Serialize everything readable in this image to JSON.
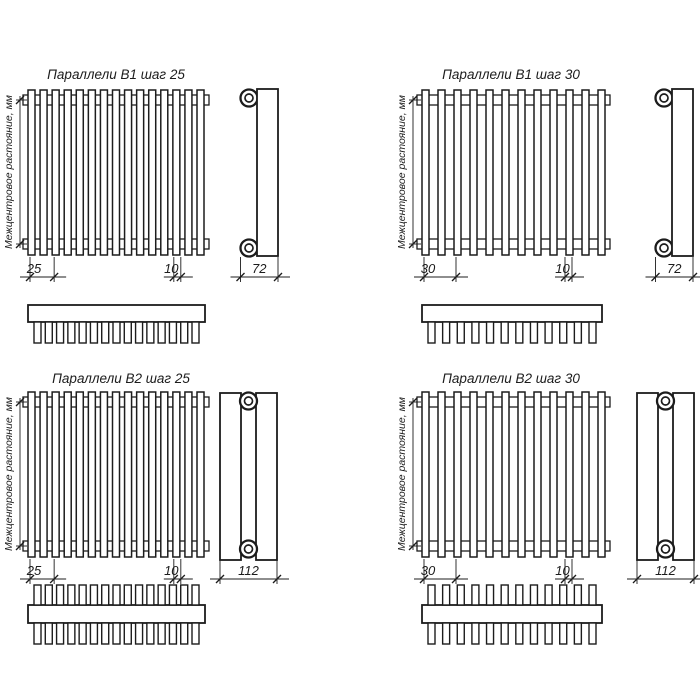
{
  "drawing": {
    "background": "#ffffff",
    "line_color": "#1c1c1c",
    "vertical_axis_label": "Межцентровое растояние, мм",
    "panels": [
      {
        "id": "b1-step-25",
        "title": "Параллели В1 шаг 25",
        "series": "В1",
        "step": 25,
        "tube_count": 15,
        "rows": 1,
        "pitch_label": "25",
        "tube_width_label": "10",
        "depth_label": "72"
      },
      {
        "id": "b1-step-30",
        "title": "Параллели В1 шаг 30",
        "series": "В1",
        "step": 30,
        "tube_count": 12,
        "rows": 1,
        "pitch_label": "30",
        "tube_width_label": "10",
        "depth_label": "72"
      },
      {
        "id": "b2-step-25",
        "title": "Параллели В2 шаг 25",
        "series": "В2",
        "step": 25,
        "tube_count": 15,
        "rows": 2,
        "pitch_label": "25",
        "tube_width_label": "10",
        "depth_label": "112"
      },
      {
        "id": "b2-step-30",
        "title": "Параллели В2 шаг 30",
        "series": "В2",
        "step": 30,
        "tube_count": 12,
        "rows": 2,
        "pitch_label": "30",
        "tube_width_label": "10",
        "depth_label": "112"
      }
    ]
  }
}
